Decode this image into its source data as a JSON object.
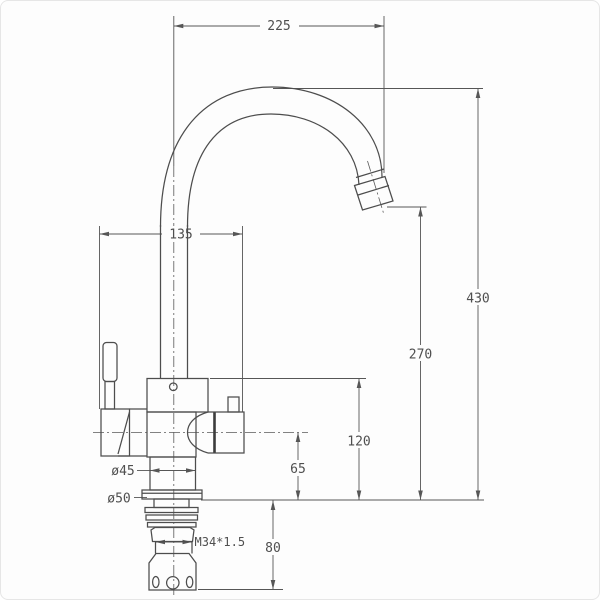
{
  "meta": {
    "drawing_type": "faucet-technical-drawing",
    "background_color": "#fdfdfd",
    "line_color": "#4d4d4d",
    "text_color": "#4f4f4f"
  },
  "dimensions": {
    "spout_reach": "225",
    "body_width": "135",
    "overall_height": "430",
    "spout_outlet_height": "270",
    "body_top_height": "120",
    "side_outlet_height": "65",
    "under_counter_depth": "80",
    "neck_diameter": "ø45",
    "base_diameter": "ø50",
    "thread_spec": "M34*1.5"
  }
}
